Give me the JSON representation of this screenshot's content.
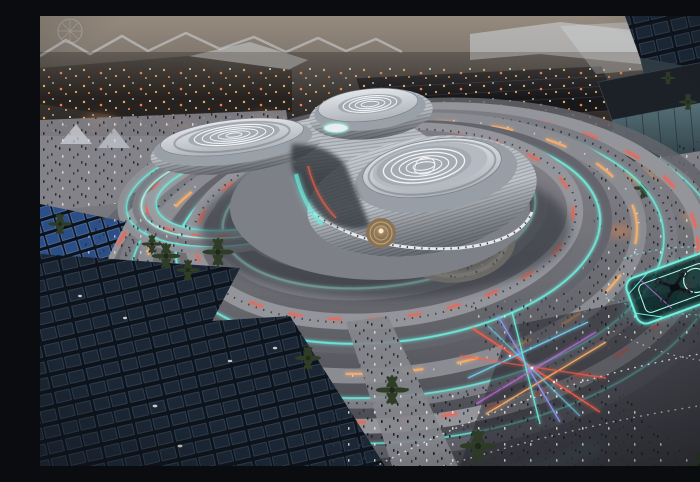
{
  "scene": {
    "alt": "Aerial dusk rendering of a futuristic three-lobed silver pavilion with fingerprint-patterned roofs, wrapped by descending spiral walkways edged in glowing cyan light with red and amber vehicle light trails, surrounded by crowds of tiny pedestrians, palm trees, dark solar-panel canopies, a sandy stepped amphitheater, a neon-outlined drone landing pad, laser light sculptures, dotted pedestrian guide arcs, and a lit expo cityscape on the horizon",
    "time_of_day": "dusk",
    "view": "aerial three-quarter",
    "elements": [
      {
        "name": "dusk-sky",
        "desc": "hazy gray-brown dusk sky strip"
      },
      {
        "name": "expo-skyline",
        "desc": "distant expo buildings with warm lights and white tensile canopies"
      },
      {
        "name": "observation-wheel",
        "desc": "faint spoked wheel structure at top left"
      },
      {
        "name": "right-district",
        "desc": "foreground buildings with dark panel roofs and a teal glass facade"
      },
      {
        "name": "spiral-track",
        "desc": "concentric descending walkway rings around the pavilion"
      },
      {
        "name": "led-edges",
        "desc": "cyan LED strips along every ring edge"
      },
      {
        "name": "light-trails",
        "desc": "red and amber streaks of moving vehicles on the track"
      },
      {
        "name": "pavilion",
        "desc": "trefoil metallic pavilion with louvered fins"
      },
      {
        "name": "fingerprint-roofs",
        "desc": "white swirling fingerprint patterns on each of the three roof discs"
      },
      {
        "name": "courtyard-feature",
        "desc": "warm circular water feature in the central canyon"
      },
      {
        "name": "amphitheater",
        "desc": "sand-colored circular stepped bowl with visitors"
      },
      {
        "name": "solar-canopies",
        "desc": "large tilted dark solar-panel canopy roofs at lower left"
      },
      {
        "name": "blue-solar-array",
        "desc": "brighter blue photovoltaic array at mid left"
      },
      {
        "name": "crowds",
        "desc": "hundreds of tiny pedestrians across plazas and walkways"
      },
      {
        "name": "palm-trees",
        "desc": "palm trees seen from above"
      },
      {
        "name": "guide-dot-arcs",
        "desc": "white dotted pedestrian guide arcs on the dark plaza"
      },
      {
        "name": "laser-sculpture",
        "desc": "crossing red, amber, blue and cyan laser light beams"
      },
      {
        "name": "drone-pad",
        "desc": "cyan neon-outlined landing platform with a small dark drone"
      },
      {
        "name": "vignette",
        "desc": "darkened corners of the frame"
      }
    ]
  },
  "counts": {
    "pavilion_lobes": 3,
    "fingerprint_roofs": 3,
    "solar_canopies": 3,
    "track_rings": 8
  },
  "palette": {
    "sky-top": "#968b7e",
    "sky-bottom": "#6f6862",
    "city-dark": "#26221f",
    "city-mid": "#45403c",
    "canopy-white": "#d8dde3",
    "warm-light": "#ffb25c",
    "warm-mid": "#ff9a4a",
    "warm-deep": "#ff8840",
    "glass-top": "#57737a",
    "glass-bottom": "#2e3d44",
    "ground-light": "#8f8e94",
    "ground-mid": "#6a6a71",
    "ground-dark": "#43434a",
    "ring-light": "#94959b",
    "ring-mid": "#7c7d84",
    "ring-dark": "#64656c",
    "cyan": "#6ff0e0",
    "cyan-soft": "#b5fbef",
    "trail-red": "#ff5f4a",
    "trail-amber": "#ffb268",
    "steel-bright": "#d6dadf",
    "steel": "#c0c5cb",
    "steel-mid": "#9aa0a7",
    "steel-dark": "#70767d",
    "under-dark": "#32373e",
    "roof-top": "#e2e5e9",
    "roof-bottom": "#adb3ba",
    "fingerprint": "#f1f3f5",
    "fp-disc": "#a4aab2",
    "panel-bg": "#0d131b",
    "panel-cell": "#1b2735",
    "panel-frame": "#3a485c",
    "panel-blue": "#2b4e86",
    "panel-blue-frame": "#5b7ab0",
    "palm": "#2f3d27",
    "palm-dark": "#1e2919",
    "crowd-dark": "#171b20",
    "crowd-mid": "#2a2f36",
    "crowd-light": "#e9e7e3",
    "sand-light": "#cfc6b6",
    "sand-mid": "#a79d8d",
    "dotline": "#e6e9ec",
    "magenta": "#c96fe0",
    "laser-blue": "#6fd4f2",
    "laser-violet": "#8f9cf5",
    "courtyard-warm": "#8a7355",
    "courtyard-ring": "#c9a97a",
    "courtyard-glow": "#ffe9c4",
    "shadow": "#24282e"
  }
}
